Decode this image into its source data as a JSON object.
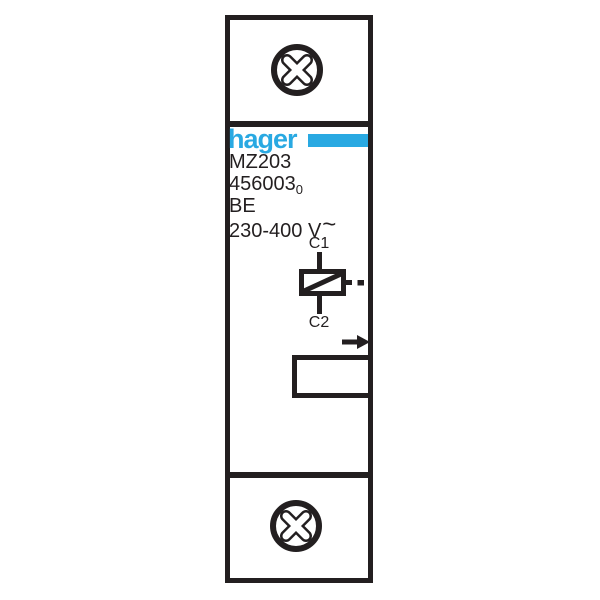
{
  "colors": {
    "line": "#231f20",
    "brand_blue": "#29a9e2",
    "background": "#ffffff"
  },
  "device": {
    "brand_logo": "hager",
    "model": "MZ203",
    "catalog_number": "456003",
    "catalog_number_index": "0",
    "origin_code": "BE",
    "voltage_rating": "230-400 V",
    "ac_symbol": "~",
    "terminal_top": "C1",
    "terminal_bottom": "C2"
  },
  "icons": {
    "screw_top": "phillips-screw-head",
    "screw_bottom": "phillips-screw-head",
    "coil": "shunt-trip-coil-symbol",
    "arrow": "right-arrow",
    "window": "label-window"
  }
}
